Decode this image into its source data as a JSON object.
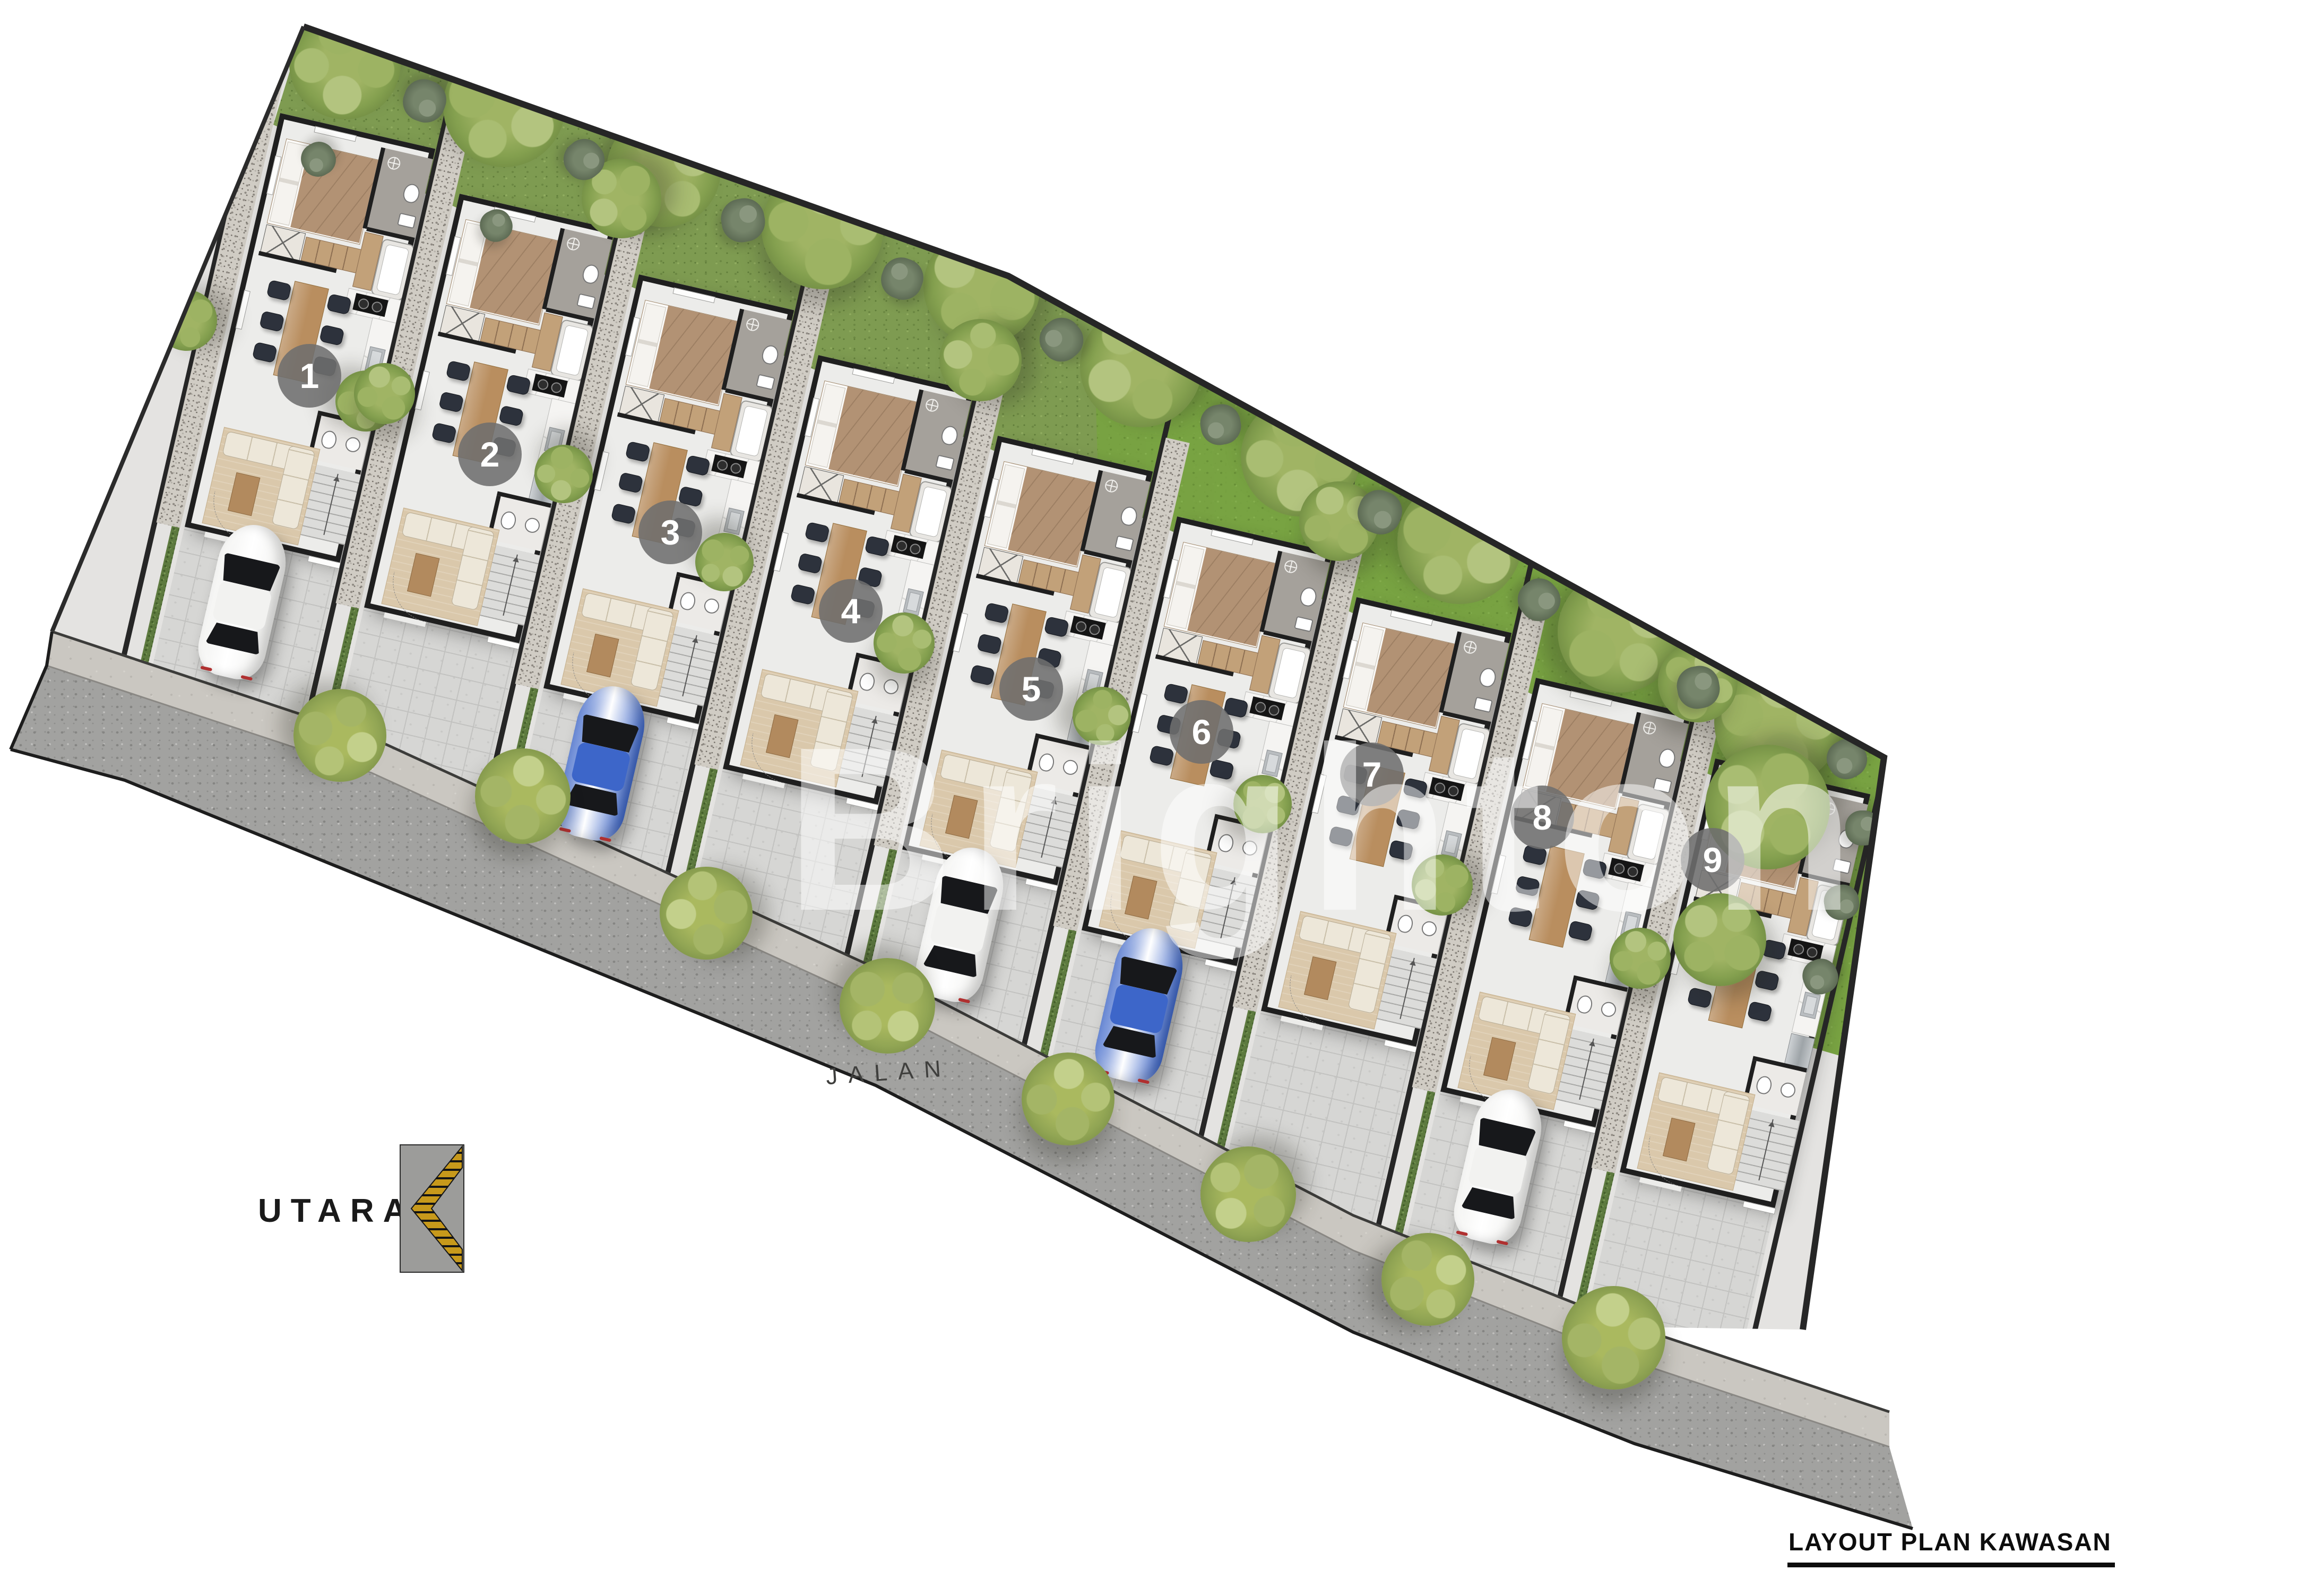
{
  "labels": {
    "title": "LAYOUT PLAN KAWASAN",
    "north": "UTARA",
    "road": "JALAN",
    "stairs": "NAIK",
    "watermark": "Brighton"
  },
  "units": [
    {
      "label": "1"
    },
    {
      "label": "2"
    },
    {
      "label": "3"
    },
    {
      "label": "4"
    },
    {
      "label": "5"
    },
    {
      "label": "6"
    },
    {
      "label": "7"
    },
    {
      "label": "8"
    },
    {
      "label": "9"
    }
  ],
  "cars": [
    {
      "unit": 1,
      "body": "#f2f2f0",
      "type": "white-car"
    },
    {
      "unit": 3,
      "body": "#3d66c9",
      "type": "blue-car"
    },
    {
      "unit": 5,
      "body": "#f2f2f0",
      "type": "white-car"
    },
    {
      "unit": 6,
      "body": "#3d66c9",
      "type": "blue-car"
    },
    {
      "unit": 8,
      "body": "#f2f2f0",
      "type": "white-car"
    }
  ],
  "colors": {
    "wall": "#1f1f1f",
    "floor": "#ececea",
    "garden_green": "#7e9b51",
    "lawn_green": "#78a441",
    "road_gray": "#a2a2a0",
    "sidewalk_gray": "#cac7c1",
    "tile_gray": "#d6d6d4",
    "wood": "#b98e5f",
    "badge_gray": "#6e6e6e",
    "north_arrow_gold": "#c7991b"
  }
}
